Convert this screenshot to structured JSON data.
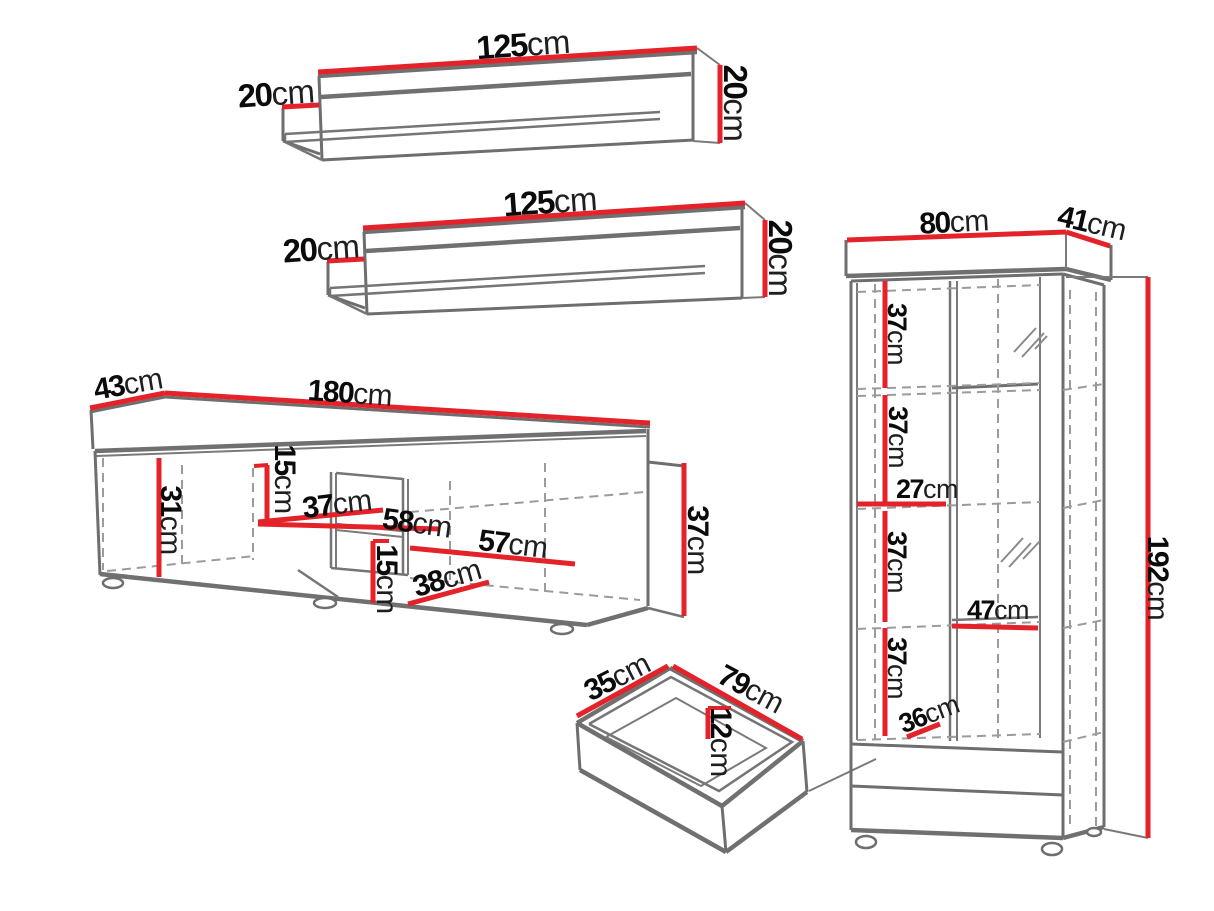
{
  "page": {
    "background": "#ffffff"
  },
  "colors": {
    "dimension_red": "#e3222a",
    "outline_gray": "#6e6e6e",
    "dash_gray": "#9b9b9b",
    "text_black": "#0b0b0b"
  },
  "unit": "cm",
  "items": {
    "wall_shelf_top": {
      "name": "wall shelf",
      "width": "125",
      "depth": "20",
      "height": "20"
    },
    "wall_shelf_middle": {
      "name": "wall shelf",
      "width": "125",
      "depth": "20",
      "height": "20"
    },
    "tv_stand": {
      "name": "TV stand",
      "depth": "43",
      "width": "180",
      "height": "37",
      "left_section_height": "31",
      "upper_niche_height": "15",
      "niche_depth": "37",
      "niche_width": "58",
      "right_shelf_width": "57",
      "lower_niche_height": "15",
      "lower_niche_width": "38"
    },
    "drawer": {
      "name": "drawer",
      "depth": "35",
      "width": "79",
      "height": "12"
    },
    "display_cabinet": {
      "name": "display cabinet",
      "width": "80",
      "depth": "41",
      "height": "192",
      "shelf_gap_1": "37",
      "shelf_gap_2": "37",
      "left_half_width": "27",
      "shelf_gap_3": "37",
      "right_half_width": "47",
      "shelf_gap_4": "37",
      "bottom_gap": "36"
    }
  }
}
